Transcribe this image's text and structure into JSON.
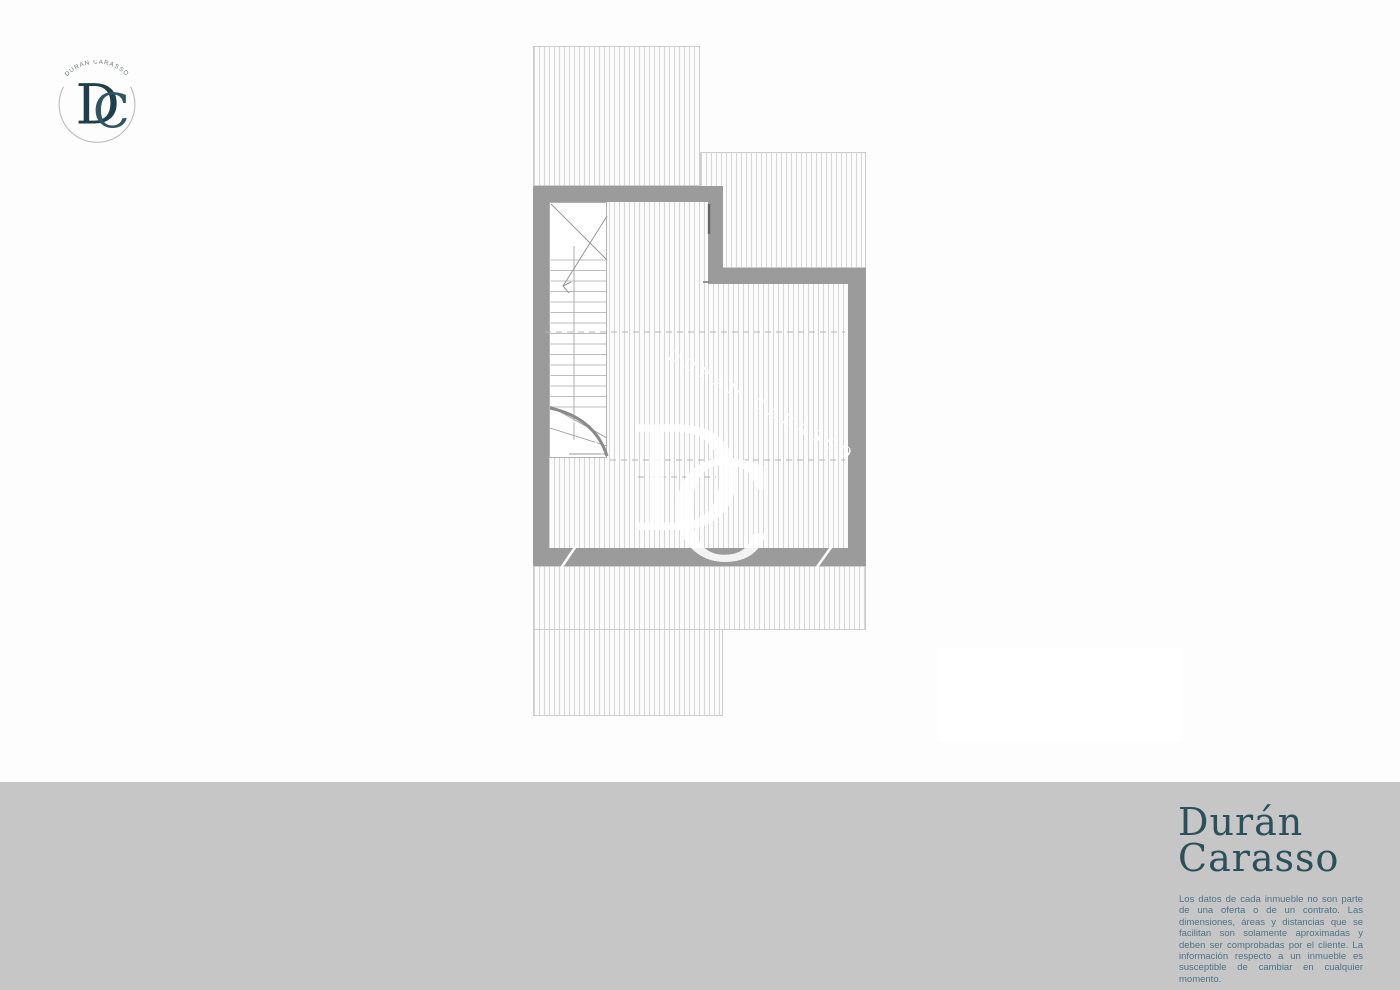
{
  "logo": {
    "arc_text": "DURAN CARASSO",
    "monogram": {
      "d": "D",
      "c": "C"
    }
  },
  "plan": {
    "watermark": {
      "diagonal_text": "DURAN CARASSO",
      "monogram_d": "D",
      "monogram_c": "C"
    }
  },
  "footer": {
    "brand": {
      "line1": "Durán",
      "line2": "Carasso"
    },
    "disclaimer_text": "Los datos de cada inmueble no son parte de una oferta o de un contrato. Las dimensiones, áreas y distancias que se facilitan son solamente aproximadas y deben ser comprobadas por el cliente. La información respecto a un inmueble es susceptible de cambiar en cualquier momento."
  },
  "colors": {
    "wall_gray": "#9b9b9b",
    "hatch_line": "#d6d6d6",
    "footer_background": "#c6c6c6",
    "brand_teal": "#2b505a",
    "disclaimer_blue": "#4e7386"
  }
}
